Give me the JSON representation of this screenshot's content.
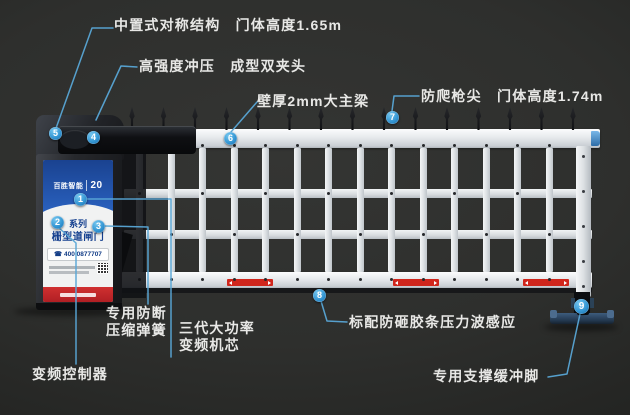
{
  "callouts": {
    "c1": {
      "num": "1",
      "line1": "三代大功率",
      "line2": "变频机芯"
    },
    "c2": {
      "num": "2",
      "text": "变频控制器"
    },
    "c3": {
      "num": "3",
      "line1": "专用防断",
      "line2": "压缩弹簧"
    },
    "c4": {
      "num": "4",
      "text": "高强度冲压　成型双夹头"
    },
    "c5": {
      "num": "5",
      "text": "中置式对称结构　门体高度1.65m"
    },
    "c6": {
      "num": "6",
      "text": "壁厚2mm大主梁"
    },
    "c7": {
      "num": "7",
      "text": "防爬枪尖　门体高度1.74m"
    },
    "c8": {
      "num": "8",
      "text": "标配防砸胶条压力波感应"
    },
    "c9": {
      "num": "9",
      "text": "专用支撑缓冲脚"
    }
  },
  "cabinet": {
    "logo_text": "百胜智能",
    "logo_year": "20",
    "series_line1": "系列",
    "series_line2": "栅型道闸门",
    "phone": "400 0877707"
  },
  "colors": {
    "leader_blue": "#58a7d6",
    "marker_blue": "#3597d4",
    "brand_blue": "#1a4290",
    "banner_red": "#b01f24",
    "strip_red": "#d0261c",
    "background": "#2e2f2d"
  }
}
